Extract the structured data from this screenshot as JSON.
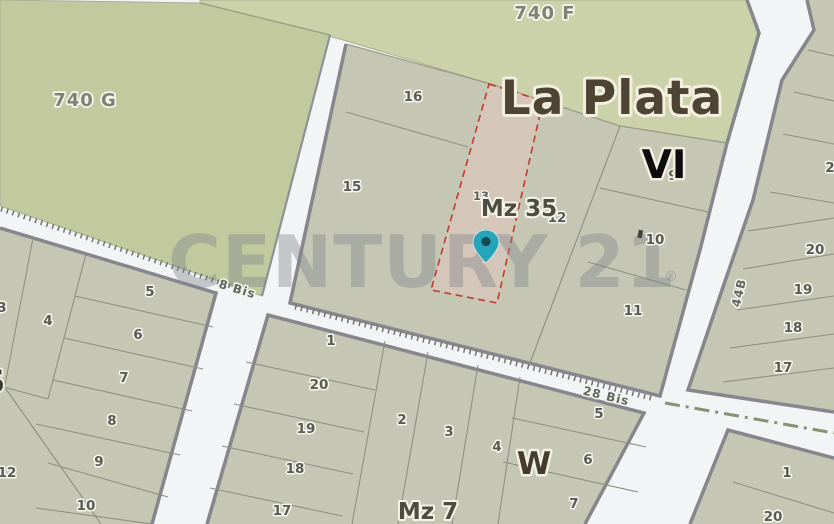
{
  "map": {
    "regions": {
      "rural_740f": "740 F",
      "rural_740g": "740 G"
    },
    "city_label": "La Plata",
    "sections": {
      "vi": "VI",
      "w": "W",
      "s": "S"
    },
    "blocks": {
      "mz35": "Mz 35",
      "mz7": "Mz 7"
    },
    "streets": {
      "bis8": "8 Bis",
      "bis28": "28 Bis",
      "b44": "44B"
    },
    "watermark": {
      "brand": "CENTURY 21",
      "registered": "®"
    },
    "lots": {
      "mz35": [
        "16",
        "15",
        "13",
        "12",
        "9",
        "10",
        "11"
      ],
      "west": [
        "3",
        "4",
        "5",
        "6",
        "7",
        "8",
        "9",
        "10",
        "12"
      ],
      "mz7": [
        "1",
        "20",
        "19",
        "18",
        "17",
        "2",
        "3",
        "4",
        "5",
        "6",
        "7"
      ],
      "east": [
        "2",
        "20",
        "19",
        "18",
        "17"
      ],
      "southeast": [
        "1",
        "20"
      ]
    },
    "selected_lot": {
      "lot": "13",
      "block": "Mz 35"
    },
    "colors": {
      "rural_area": "#cbd1a8",
      "rural_area_dark": "#c2c99e",
      "block_fill": "#c5c7b4",
      "road": "#f3f4f6",
      "road_casing": "#84878b",
      "selected_fill": "#d4c6b9",
      "selected_outline": "#c23b2e",
      "marker": "#26a4ba",
      "watermark": "#80848b"
    }
  }
}
